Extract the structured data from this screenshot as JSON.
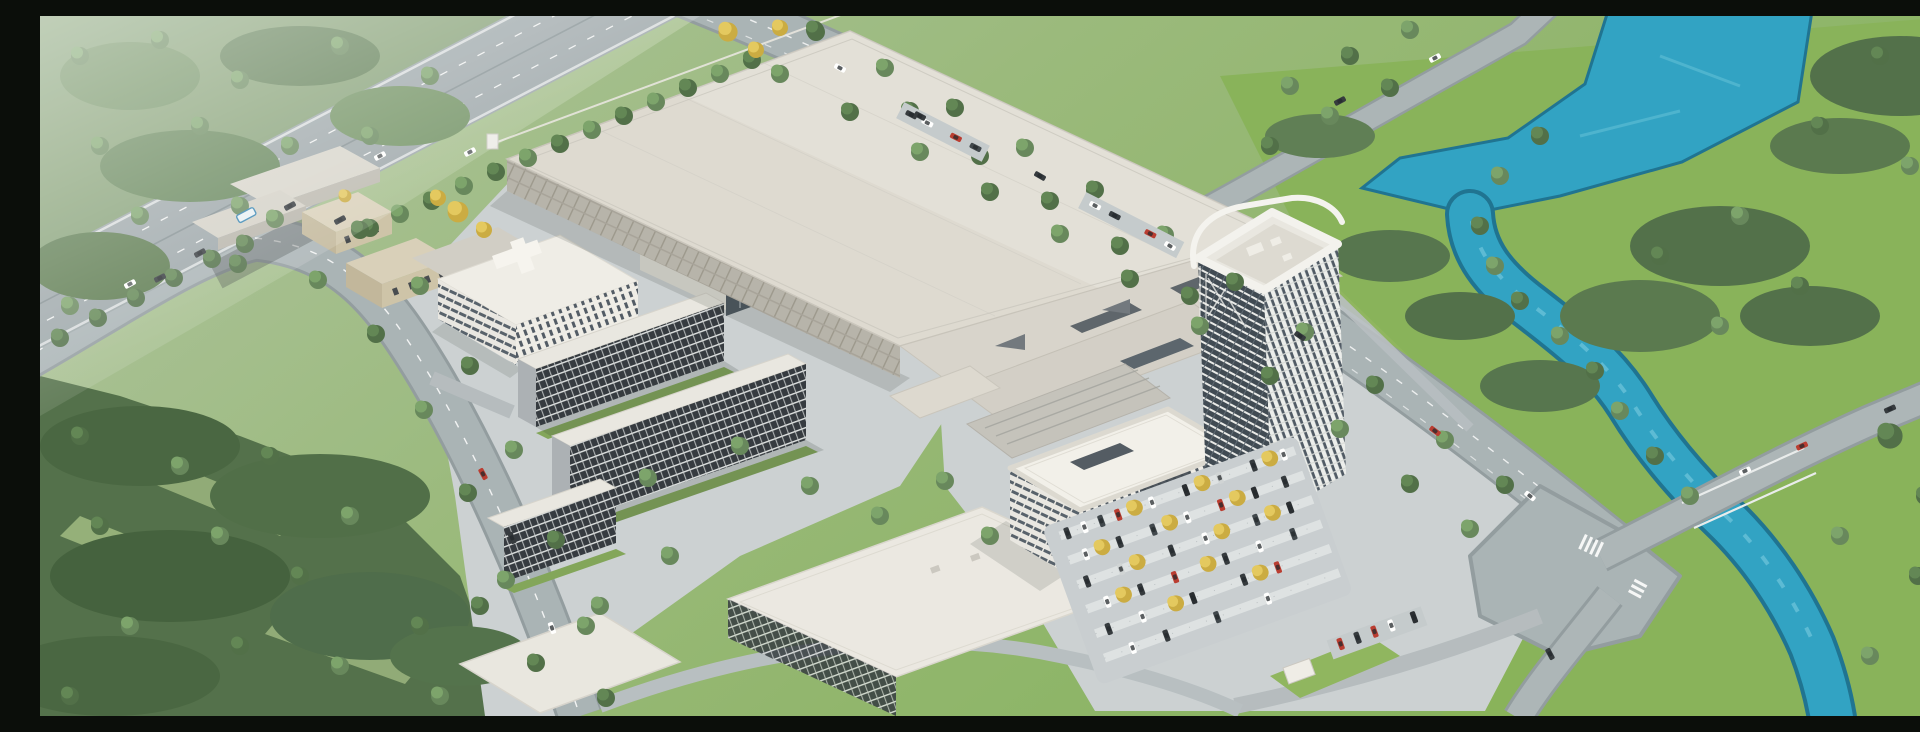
{
  "scene": {
    "type": "aerial-architectural-rendering",
    "title": "Daytime aerial rendering of a large industrial campus: a vast white factory hall, a curved high-rise office tower, dormitory blocks with dense window grids, office buildings, tree-lined boulevards, a highway overpass, surface parking lots full of cars, bright green fields and a winding teal river",
    "labels": {
      "highway": "elevated highway overpass with traffic, north-west corner",
      "north_boulevard": "tree-lined boulevard along the north-east edge of the campus",
      "southwest_boulevard": "curving tree-lined boulevard on the south-west edge",
      "river": "winding teal river widening into a pond at the top right",
      "bridge_road": "road crossing the river at the south-east junction",
      "factory": "main factory production hall with vast flat light roof",
      "annex": "connected annex halls with courtyards and triangular skylights",
      "tower": "curved white high-rise office tower with glazed facades",
      "front_office": "rounded-corner office building in front of the tower",
      "dormitories": "dormitory slabs with dense dark window grids",
      "south_buildings": "flat-roofed white logistics buildings at the south edge",
      "research_buildings": "research buildings with glass atrium west of the factory",
      "west_houses": "small tan service houses west of the factory",
      "parking": "surface parking lots with rows of cars and golden trees",
      "forest": "dense tree clusters, meadows and lawns",
      "fields": "bright green fields east of the river",
      "haze": "soft atmospheric haze over the north-west fields"
    }
  },
  "palette": {
    "grass_bright": "#86b155",
    "grass_pale": "#b7c9ad",
    "forest_dark": "#42603b",
    "tree_light": "#6f9a5f",
    "autumn_yellow": "#e0c254",
    "water": "#2aa0c2",
    "water_deep": "#176f8e",
    "road": "#9aa5a9",
    "road_light": "#adb5b8",
    "pavement": "#cad0d2",
    "roof_white": "#efede7",
    "roof_warm": "#ddd9d0",
    "facade_dark": "#31373d",
    "glass": "#46515b",
    "tan_wall": "#cdc2a6",
    "car_red": "#b8362a",
    "white": "#f3f2ee"
  }
}
